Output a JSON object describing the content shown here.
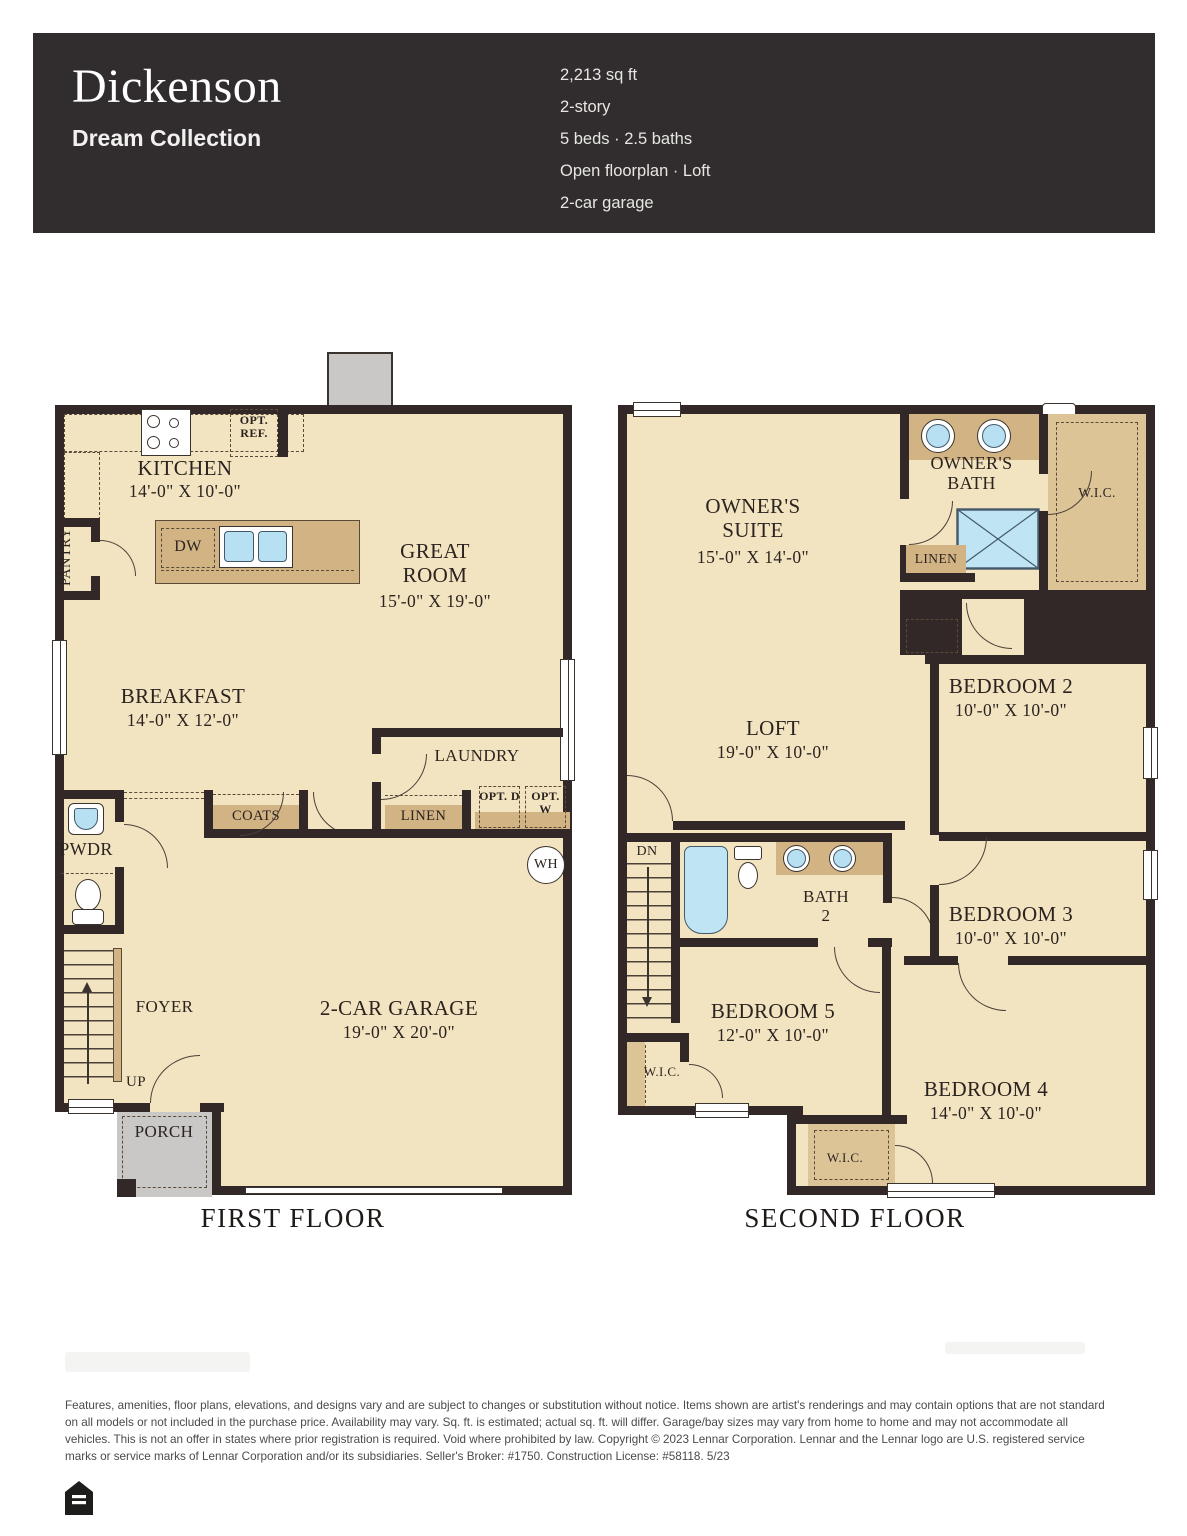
{
  "header": {
    "title": "Dickenson",
    "collection": "Dream Collection",
    "specs": [
      "2,213 sq ft",
      "2-story",
      "5 beds · 2.5 baths",
      "Open floorplan · Loft",
      "2-car garage"
    ]
  },
  "colors": {
    "header_bg": "#312d2e",
    "wall": "#322827",
    "floor_cream": "#f3e4c1",
    "counter_tan": "#d2b384",
    "fixture_blue": "#b7e1f3",
    "porch_gray": "#c9c8c6"
  },
  "first_floor": {
    "title": "FIRST FLOOR",
    "kitchen_name": "KITCHEN",
    "kitchen_dims": "14'-0\" X 10'-0\"",
    "great_room_name": "GREAT ROOM",
    "great_room_dims": "15'-0\" X 19'-0\"",
    "breakfast_name": "BREAKFAST",
    "breakfast_dims": "14'-0\" X 12'-0\"",
    "garage_name": "2-CAR GARAGE",
    "garage_dims": "19'-0\" X 20'-0\"",
    "pantry": "PANTRY",
    "pwdr": "PWDR",
    "foyer": "FOYER",
    "up": "UP",
    "porch": "PORCH",
    "coats": "COATS",
    "linen": "LINEN",
    "laundry": "LAUNDRY",
    "opt_ref": "OPT. REF.",
    "opt_d": "OPT. D",
    "opt_w": "OPT. W",
    "dw": "DW",
    "wh": "WH"
  },
  "second_floor": {
    "title": "SECOND FLOOR",
    "owners_suite_name": "OWNER'S SUITE",
    "owners_suite_dims": "15'-0\" X 14'-0\"",
    "owners_bath": "OWNER'S BATH",
    "wic_owner": "W.I.C.",
    "linen": "LINEN",
    "loft_name": "LOFT",
    "loft_dims": "19'-0\" X 10'-0\"",
    "bedroom2_name": "BEDROOM 2",
    "bedroom2_dims": "10'-0\" X 10'-0\"",
    "bedroom3_name": "BEDROOM 3",
    "bedroom3_dims": "10'-0\" X 10'-0\"",
    "bedroom4_name": "BEDROOM 4",
    "bedroom4_dims": "14'-0\" X 10'-0\"",
    "bedroom5_name": "BEDROOM 5",
    "bedroom5_dims": "12'-0\" X 10'-0\"",
    "bath2": "BATH 2",
    "dn": "DN",
    "wic5": "W.I.C.",
    "wic4": "W.I.C."
  },
  "footer": {
    "disclaimer": "Features, amenities, floor plans, elevations, and designs vary and are subject to changes or substitution without notice. Items shown are artist's renderings and may contain options that are not standard on all models or not included in the purchase price. Availability may vary. Sq. ft. is estimated; actual sq. ft. will differ. Garage/bay sizes may vary from home to home and may not accommodate all vehicles. This is not an offer in states where prior registration is required. Void where prohibited by law. Copyright © 2023 Lennar Corporation. Lennar and the Lennar logo are U.S. registered service marks or service marks of Lennar Corporation and/or its subsidiaries. Seller's Broker: #1750. Construction License: #58118. 5/23"
  }
}
